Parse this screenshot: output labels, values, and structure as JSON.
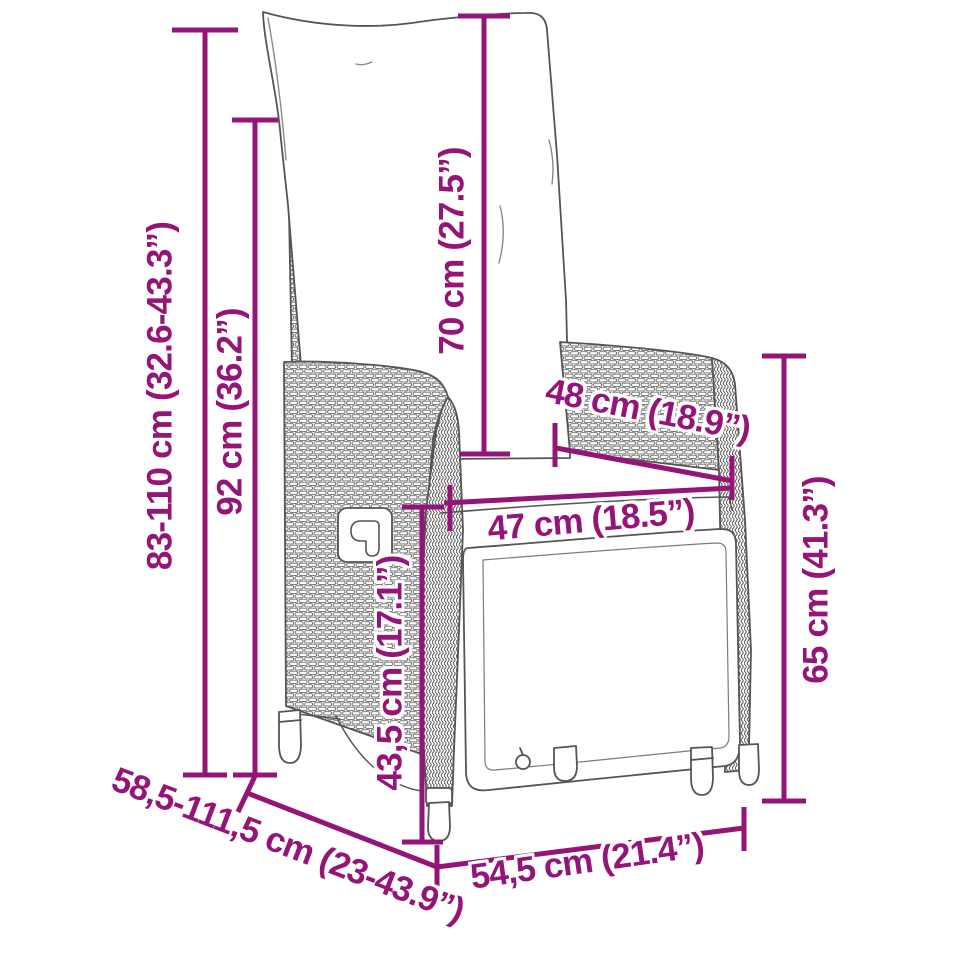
{
  "diagram": {
    "accent_color": "#951478",
    "illustration_alt": "Line drawing of a poly rattan reclining garden chair with back and seat cushions",
    "dimensions": [
      {
        "name": "total-height-range",
        "label": "83-110 cm (32.6-43.3”)"
      },
      {
        "name": "backrest-height",
        "label": "92 cm (36.2”)"
      },
      {
        "name": "back-cushion-height",
        "label": "70 cm (27.5”)"
      },
      {
        "name": "seat-depth",
        "label": "48 cm (18.9”)"
      },
      {
        "name": "seat-width",
        "label": "47 cm (18.5”)"
      },
      {
        "name": "seat-height",
        "label": "43,5 cm (17.1”)"
      },
      {
        "name": "armrest-height",
        "label": "65 cm (41.3”)"
      },
      {
        "name": "total-depth-range",
        "label": "58,5-111,5 cm (23-43.9”)"
      },
      {
        "name": "total-width",
        "label": "54,5 cm (21.4”)"
      }
    ]
  }
}
